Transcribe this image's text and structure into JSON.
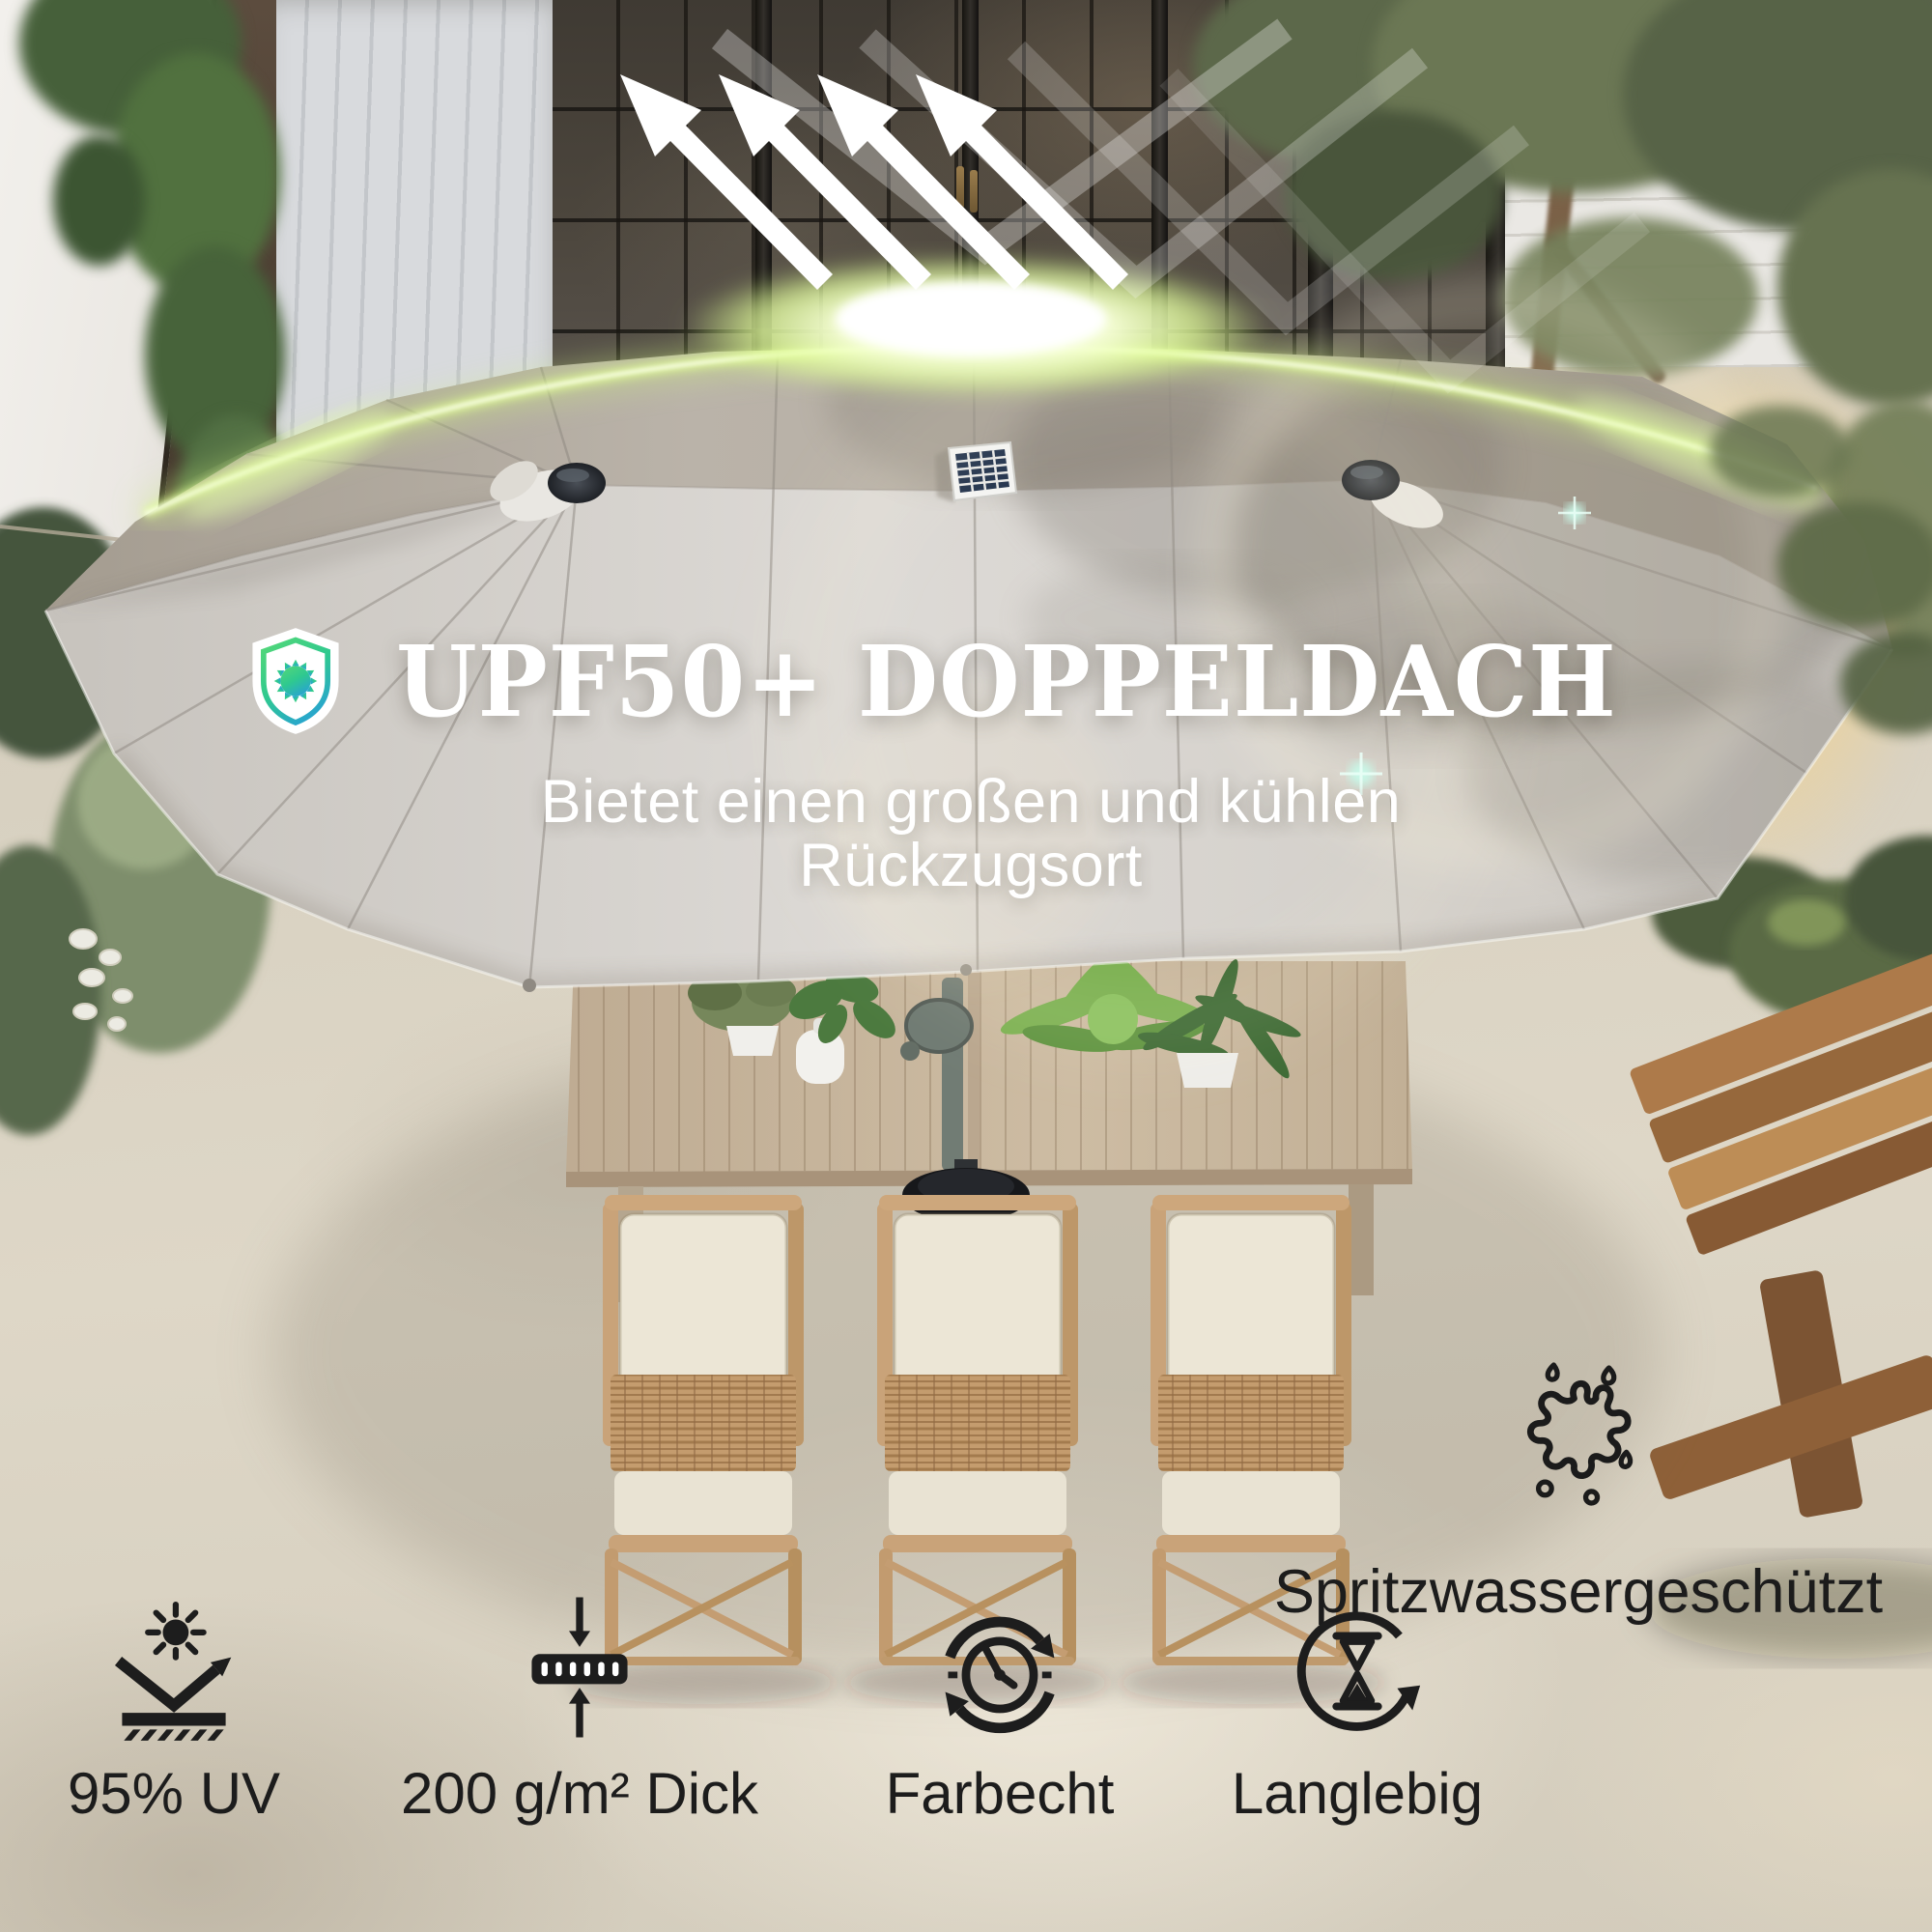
{
  "hero": {
    "icon": "upf-shield-sun-icon",
    "title": "UPF50+ DOPPELDACH",
    "subtitle": "Bietet einen großen und kühlen Rückzugsort"
  },
  "splash_feature": {
    "icon": "water-splash-icon",
    "label": "Spritzwassergeschützt"
  },
  "features": [
    {
      "icon": "uv-reflection-icon",
      "label": "95% UV"
    },
    {
      "icon": "fabric-thickness-icon",
      "label": "200 g/m² Dick"
    },
    {
      "icon": "colorfast-clock-icon",
      "label": "Farbecht"
    },
    {
      "icon": "hourglass-cycle-icon",
      "label": "Langlebig"
    }
  ],
  "colors": {
    "accent_green": "#4ad47f",
    "accent_teal": "#2aa9c9",
    "glow_green": "#e3ff9a",
    "canopy_light": "#d7d4cf",
    "canopy_dark": "#b2aa9f",
    "headline_text": "#ffffff",
    "feature_text": "#1c1c1c"
  }
}
